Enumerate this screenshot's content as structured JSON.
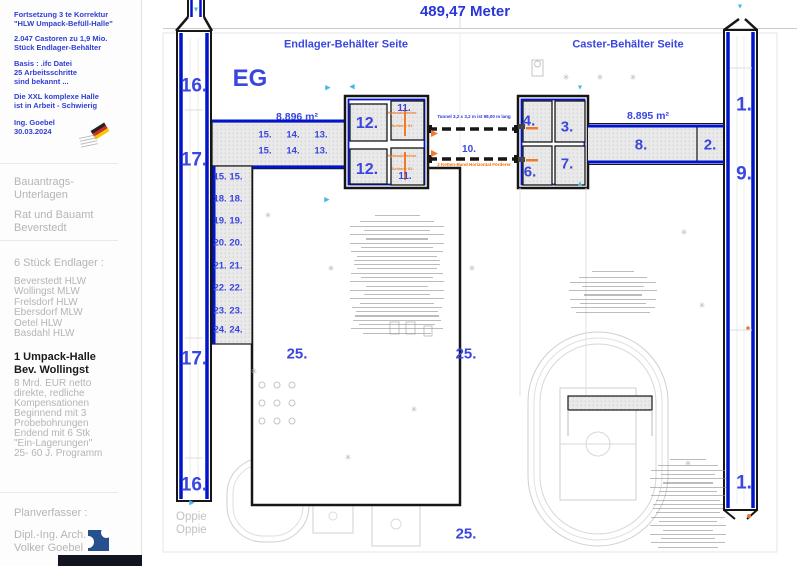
{
  "header": {
    "title": "489,47 Meter"
  },
  "sidebar": {
    "blue1": [
      "Fortsetzung 3 te Korrektur",
      "\"HLW Umpack-Befüll-Halle\""
    ],
    "blue2": [
      "2.047 Castoren zu 1,9 Mio.",
      "Stück Endlager-Behälter"
    ],
    "blue3": [
      "Basis : .ifc Datei",
      "25 Arbeitsschritte",
      "sind bekannt ..."
    ],
    "blue4": [
      "Die XXL komplexe Halle",
      "ist in Arbeit - Schwierig"
    ],
    "blue5": [
      "Ing. Goebel",
      "30.03.2024"
    ],
    "gray1": [
      "Bauantrags-",
      "Unterlagen"
    ],
    "gray2": [
      "Rat und Bauamt",
      "Beverstedt"
    ],
    "endlager_heading": "6 Stück Endlager :",
    "endlager_list": [
      "Beverstedt HLW",
      "Wollingst MLW",
      "Frelsdorf HLW",
      "Ebersdorf MLW",
      "Oetel HLW",
      "Basdahl HLW"
    ],
    "black_block": [
      "1 Umpack-Halle",
      "Bev. Wollingst"
    ],
    "gray3": [
      "8 Mrd. EUR netto",
      "direkte, redliche",
      "Kompensationen",
      "Beginnend mit 3",
      "Probebohrungen",
      "Endend mit 6 Stk",
      "\"Ein-Lagerungen\"",
      "25- 60 J. Programm"
    ],
    "planverfasser": "Planverfasser :",
    "author": [
      "Dipl.-Ing. Arch.",
      "Volker Goebel"
    ]
  },
  "plan": {
    "colors": {
      "wall_blue": "#0014cc",
      "label_blue": "#3a46e0",
      "orange": "#f07a2a",
      "cyan_marker": "#45b8e8"
    },
    "annotations": {
      "tunnel": "Tunnel 3,2 x 3,2 m ist 98,00 m lang",
      "conveyor": "2 Ketten-Band Horizontal Förderer",
      "rail1": [
        "Hydraulikheber",
        "→",
        "Schiene 01"
      ],
      "rail2": [
        "Hydraulikheber",
        "→",
        "Schiene 02"
      ],
      "oppie": [
        "Oppie",
        "Oppie"
      ]
    },
    "labels": [
      {
        "t": "Endlager-Behälter Seite",
        "x": 346,
        "y": 45,
        "fs": 11
      },
      {
        "t": "Caster-Behälter Seite",
        "x": 628,
        "y": 45,
        "fs": 11
      },
      {
        "t": "EG",
        "x": 250,
        "y": 79,
        "fs": 24
      },
      {
        "t": "8.896 m²",
        "x": 297,
        "y": 117,
        "fs": 10.5
      },
      {
        "t": "8.895 m²",
        "x": 648,
        "y": 116,
        "fs": 10.5
      },
      {
        "t": "16.",
        "x": 194,
        "y": 86,
        "fs": 19
      },
      {
        "t": "17.",
        "x": 194,
        "y": 160,
        "fs": 19
      },
      {
        "t": "17.",
        "x": 194,
        "y": 359,
        "fs": 19
      },
      {
        "t": "16.",
        "x": 194,
        "y": 485,
        "fs": 19
      },
      {
        "t": "1.",
        "x": 744,
        "y": 105,
        "fs": 19
      },
      {
        "t": "9.",
        "x": 744,
        "y": 174,
        "fs": 19
      },
      {
        "t": "1.",
        "x": 744,
        "y": 483,
        "fs": 19
      },
      {
        "t": "2.",
        "x": 710,
        "y": 145,
        "fs": 15
      },
      {
        "t": "8.",
        "x": 641,
        "y": 145,
        "fs": 15
      },
      {
        "t": "4.",
        "x": 529,
        "y": 121,
        "fs": 15
      },
      {
        "t": "3.",
        "x": 567,
        "y": 127,
        "fs": 15
      },
      {
        "t": "6.",
        "x": 530,
        "y": 172,
        "fs": 15
      },
      {
        "t": "7.",
        "x": 567,
        "y": 164,
        "fs": 15
      },
      {
        "t": "12.",
        "x": 367,
        "y": 124,
        "fs": 16
      },
      {
        "t": "12.",
        "x": 367,
        "y": 170,
        "fs": 16
      },
      {
        "t": "11.",
        "x": 404,
        "y": 109,
        "fs": 10
      },
      {
        "t": "11.",
        "x": 405,
        "y": 177,
        "fs": 10
      },
      {
        "t": "10.",
        "x": 469,
        "y": 150,
        "fs": 10
      },
      {
        "t": "15.",
        "x": 265,
        "y": 135,
        "fs": 9.5
      },
      {
        "t": "14.",
        "x": 293,
        "y": 135,
        "fs": 9.5
      },
      {
        "t": "13.",
        "x": 321,
        "y": 135,
        "fs": 9.5
      },
      {
        "t": "15.",
        "x": 265,
        "y": 151,
        "fs": 9.5
      },
      {
        "t": "14.",
        "x": 293,
        "y": 151,
        "fs": 9.5
      },
      {
        "t": "13.",
        "x": 321,
        "y": 151,
        "fs": 9.5
      },
      {
        "t": "15. 15.",
        "x": 228,
        "y": 177,
        "fs": 9.5
      },
      {
        "t": "18. 18.",
        "x": 228,
        "y": 199,
        "fs": 9.5
      },
      {
        "t": "19. 19.",
        "x": 228,
        "y": 221,
        "fs": 9.5
      },
      {
        "t": "20. 20.",
        "x": 228,
        "y": 243,
        "fs": 9.5
      },
      {
        "t": "21. 21.",
        "x": 228,
        "y": 266,
        "fs": 9.5
      },
      {
        "t": "22. 22.",
        "x": 228,
        "y": 288,
        "fs": 9.5
      },
      {
        "t": "23. 23.",
        "x": 228,
        "y": 311,
        "fs": 9.5
      },
      {
        "t": "24. 24.",
        "x": 228,
        "y": 330,
        "fs": 9.5
      },
      {
        "t": "25.",
        "x": 297,
        "y": 354,
        "fs": 15
      },
      {
        "t": "25.",
        "x": 466,
        "y": 354,
        "fs": 15
      },
      {
        "t": "25.",
        "x": 466,
        "y": 534,
        "fs": 15
      }
    ],
    "trees": [
      [
        268,
        216
      ],
      [
        331,
        269
      ],
      [
        472,
        269
      ],
      [
        566,
        78
      ],
      [
        600,
        78
      ],
      [
        633,
        78
      ],
      [
        684,
        233
      ],
      [
        702,
        306
      ],
      [
        348,
        458
      ],
      [
        414,
        410
      ],
      [
        688,
        464
      ],
      [
        254,
        372
      ]
    ],
    "markers": [
      [
        196,
        10,
        "d"
      ],
      [
        328,
        88,
        "r"
      ],
      [
        352,
        87,
        "l"
      ],
      [
        580,
        88,
        "d"
      ],
      [
        580,
        184,
        "u"
      ],
      [
        740,
        7,
        "d"
      ],
      [
        192,
        503,
        "r"
      ],
      [
        327,
        200,
        "r"
      ]
    ]
  }
}
